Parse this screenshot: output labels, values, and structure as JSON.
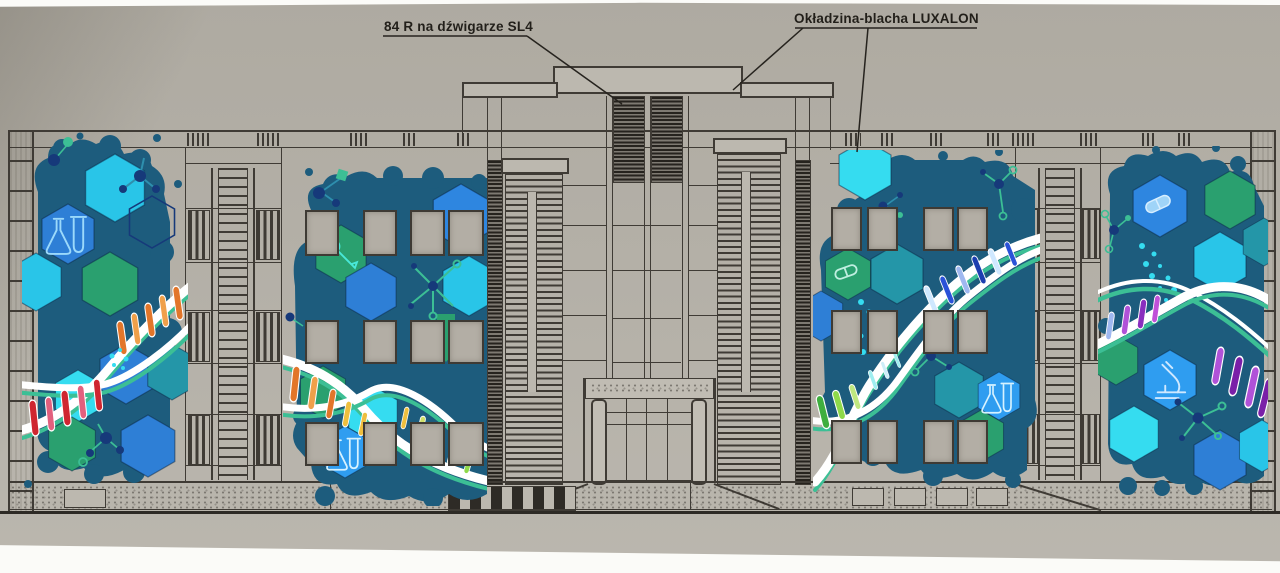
{
  "annotations": {
    "girder_label": "84 R na dźwigarze SL4",
    "cladding_label": "Okładzina-blacha LUXALON"
  },
  "palette": {
    "paper": "#b6b2a9",
    "line": "#3f3b35",
    "mural_background": "#1d5c7d",
    "cyan": "#29c5e8",
    "bright_cyan": "#35dcf0",
    "blue": "#2e7fd6",
    "bright_blue": "#2f9df0",
    "royal_blue": "#2e86e0",
    "teal": "#2496a8",
    "green": "#2aa06f",
    "mint": "#3cbf95",
    "navy": "#16397a",
    "white": "#ffffff",
    "orange": "#e2762a",
    "light_orange": "#f0a04a",
    "red": "#cf2630",
    "pink": "#e2607e",
    "yellow": "#eebf3e",
    "lime": "#8fd94a",
    "leaf_green": "#3fae3f",
    "purple": "#b052d8",
    "violet": "#7a1fa8",
    "window_gray": "#b3aea5"
  },
  "murals": [
    {
      "name": "mural-panel-1",
      "theme": "DNA double helix with hexagons, lab flasks and molecule motifs",
      "icons": [
        "flask-icon",
        "dna-helix",
        "hexagon-pattern",
        "molecule-icon"
      ]
    },
    {
      "name": "mural-panel-2",
      "theme": "DNA helix flowing across windows with down arrow, tool and flask hexagons",
      "icons": [
        "wrench-icon",
        "flask-icon",
        "dna-helix",
        "arrow-down-icon",
        "molecule-icon"
      ]
    },
    {
      "name": "mural-panel-3",
      "theme": "DNA helix across windows with capsule and flask hexagons",
      "icons": [
        "capsule-icon",
        "flask-icon",
        "dna-helix",
        "molecule-icon"
      ]
    },
    {
      "name": "mural-panel-4",
      "theme": "DNA helix with microscope hexagon and spilling pill capsule",
      "icons": [
        "capsule-icon",
        "microscope-icon",
        "dna-helix",
        "molecule-icon"
      ]
    }
  ]
}
